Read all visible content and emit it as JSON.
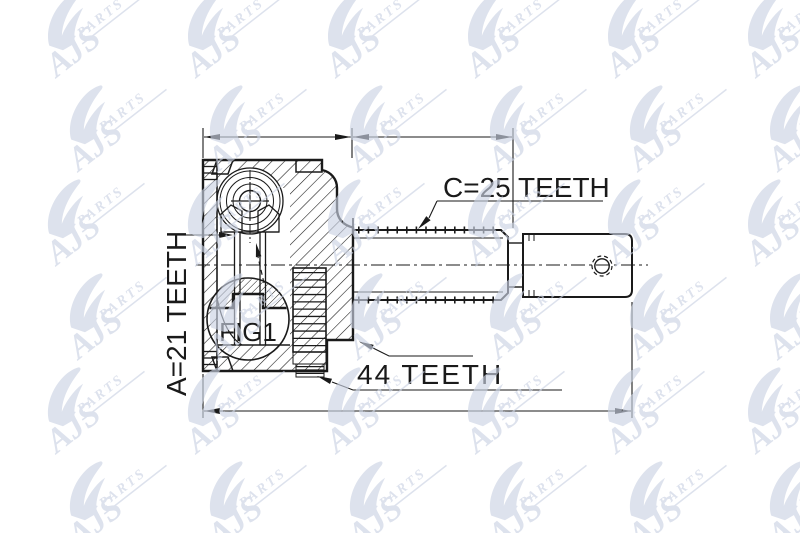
{
  "page": {
    "background": "#ffffff"
  },
  "diagram": {
    "type": "technical-drawing",
    "subject": "CV joint outer cross-section",
    "labels": {
      "outer_spline": "C=25 TEETH",
      "inner_spline": "A=21 TEETH",
      "abs_ring": "44 TEETH",
      "figure_ref": "FIG1"
    },
    "colors": {
      "line": "#1a1a1a",
      "watermark": "#cbd2e3",
      "background": "#ffffff"
    }
  },
  "watermark": {
    "brand": "AJS",
    "brand_sub": "PARTS"
  }
}
